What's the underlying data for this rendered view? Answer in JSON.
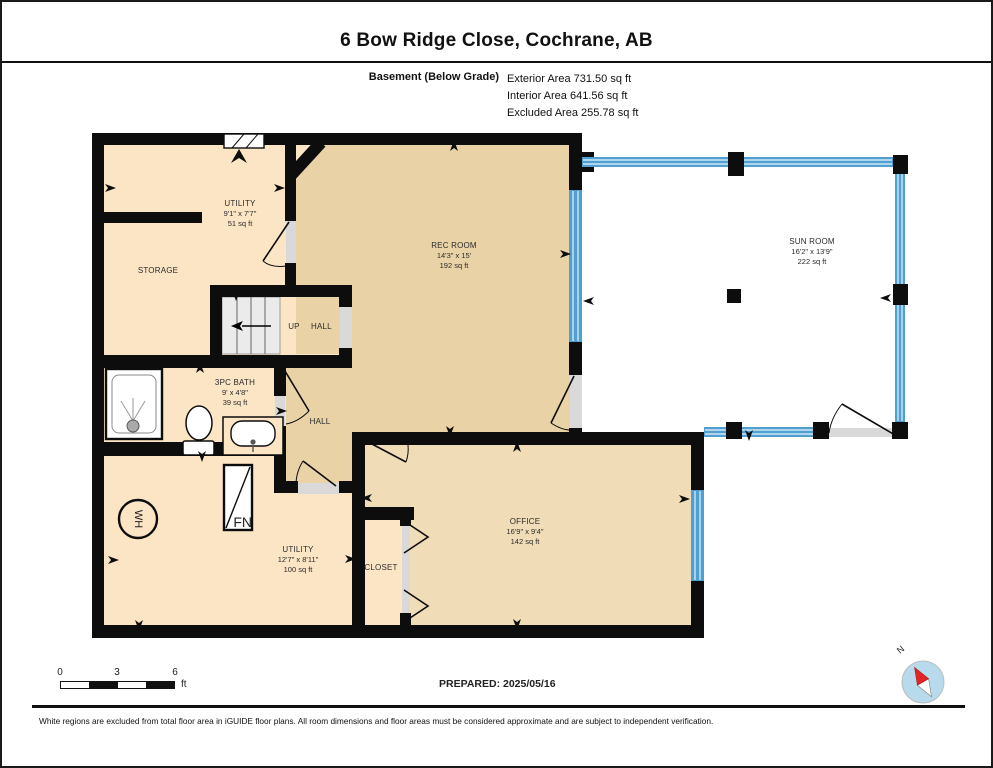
{
  "title": "6 Bow Ridge Close, Cochrane, AB",
  "floor": {
    "name": "Basement (Below Grade)",
    "area_lines": [
      "Exterior Area 731.50 sq ft",
      "Interior Area 641.56 sq ft",
      "Excluded Area 255.78 sq ft"
    ]
  },
  "rooms": [
    {
      "name": "UTILITY",
      "dims": "9'1\" x 7'7\"",
      "area": "51 sq ft"
    },
    {
      "name": "STORAGE"
    },
    {
      "name": "REC ROOM",
      "dims": "14'3\" x 15'",
      "area": "192 sq ft"
    },
    {
      "name": "SUN ROOM",
      "dims": "16'2\" x 13'9\"",
      "area": "222 sq ft"
    },
    {
      "name": "UP HALL"
    },
    {
      "name": "3PC BATH",
      "dims": "9' x 4'8\"",
      "area": "39 sq ft"
    },
    {
      "name": "HALL"
    },
    {
      "name": "UTILITY",
      "dims": "12'7\" x 8'11\"",
      "area": "100 sq ft"
    },
    {
      "name": "CLOSET"
    },
    {
      "name": "OFFICE",
      "dims": "16'9\" x 9'4\"",
      "area": "142 sq ft"
    }
  ],
  "fixtures": {
    "water_heater": "WH",
    "furnace": "FN"
  },
  "scale_bar": {
    "ticks": [
      "0",
      "3",
      "6"
    ],
    "unit": "ft"
  },
  "prepared": "PREPARED: 2025/05/16",
  "compass": {
    "north_label": "N"
  },
  "footer": "White regions are excluded from total floor area in iGUIDE floor plans. All room dimensions and floor areas must be considered approximate and are subject to independent verification.",
  "colors": {
    "wall": "#0d0d0d",
    "window": "#4f9fd0",
    "stripe": "#cfe8f6",
    "floor_light": "#fce5c5",
    "floor_dark": "#e9d2a6",
    "floor_mid": "#f0dcb6",
    "threshold": "#d9d9d9",
    "compass_fill": "#b7dbec",
    "needle": "#e02428"
  }
}
